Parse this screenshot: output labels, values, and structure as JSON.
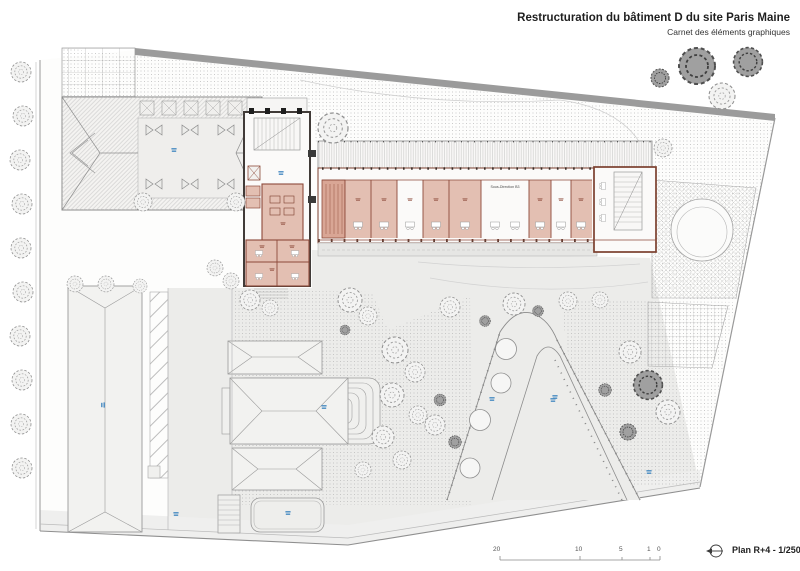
{
  "header": {
    "title": "Restructuration du bâtiment D du site Paris Maine",
    "subtitle": "Carnet des éléments graphiques"
  },
  "plan": {
    "room_labels": {
      "sous_direction": "Sous-Direction B3"
    },
    "colors": {
      "room_fill_pink": "#e3bfb2",
      "room_fill_dark_pink": "#d9a695",
      "wall_accent_red": "#8d4a3a",
      "wall_dark": "#2e2b29",
      "annotation_blue": "#4a8cc2",
      "boundary_gray": "#9b9b9b",
      "ground_gray": "#ececea"
    }
  },
  "footer": {
    "plan_label": "Plan R+4 - 1/250",
    "north_icon": "north-arrow-icon",
    "scale_ticks": [
      "20",
      "10",
      "5",
      "1",
      "0"
    ]
  }
}
